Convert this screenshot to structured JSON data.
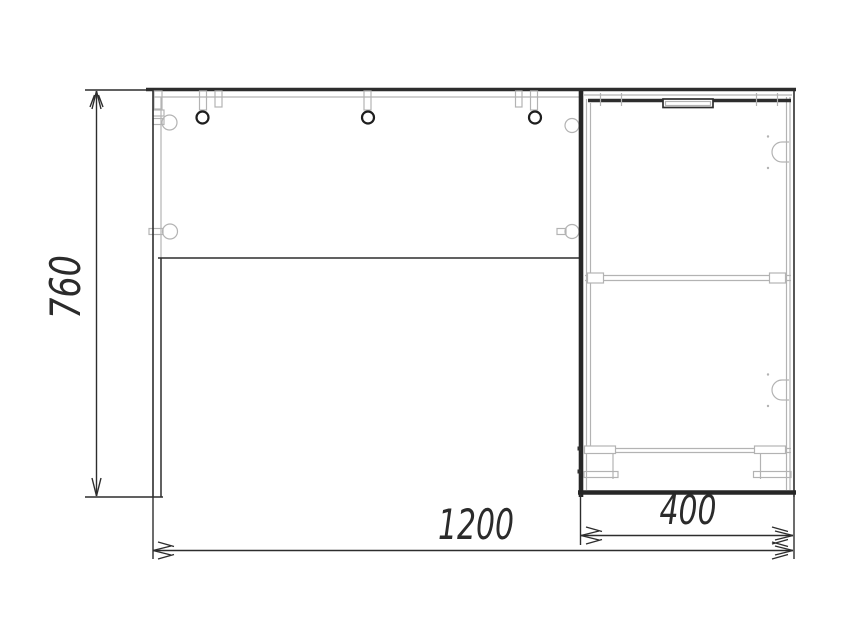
{
  "drawing": {
    "type": "furniture-front-elevation",
    "subject": "corner desk with side cabinet, front view technical drawing",
    "dimensions": {
      "height_mm": "760",
      "overall_width_mm": "1200",
      "cabinet_width_mm": "400"
    },
    "colors": {
      "background": "#ffffff",
      "line_dark": "#2d2d2d",
      "line_light": "#b3b3b3"
    }
  }
}
